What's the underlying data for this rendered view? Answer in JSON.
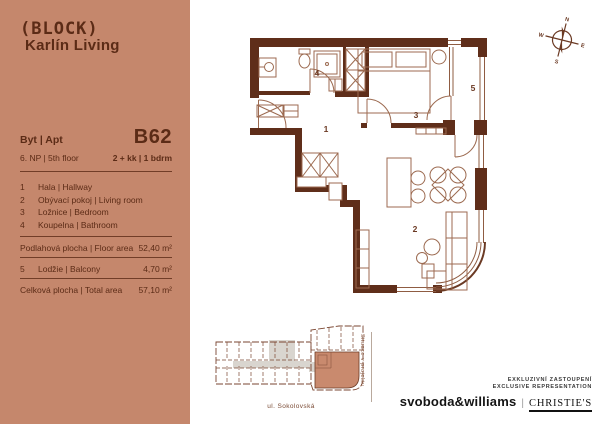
{
  "panel": {
    "logo_line1": "(BLOCK)",
    "logo_line2": "Karlín Living",
    "apt_label": "Byt | Apt",
    "apt_number": "B62",
    "floor": "6. NP | 5th floor",
    "layout": "2 + kk | 1 bdrm",
    "rooms": [
      {
        "num": "1",
        "name": "Hala | Hallway"
      },
      {
        "num": "2",
        "name": "Obývací pokoj | Living room"
      },
      {
        "num": "3",
        "name": "Ložnice | Bedroom"
      },
      {
        "num": "4",
        "name": "Koupelna | Bathroom"
      }
    ],
    "floor_area_label": "Podlahová plocha | Floor area",
    "floor_area_value": "52,40 m²",
    "balcony_num": "5",
    "balcony_label": "Lodžie | Balcony",
    "balcony_value": "4,70 m²",
    "total_label": "Celková plocha | Total area",
    "total_value": "57,10 m²"
  },
  "plan": {
    "labels": {
      "hall": "1",
      "living": "2",
      "bedroom": "3",
      "bathroom": "4",
      "balcony": "5"
    }
  },
  "compass": {
    "n": "N",
    "e": "E",
    "s": "S",
    "w": "W"
  },
  "siteplan": {
    "street": "ul. Sokolovská",
    "side_label": "Situace v projektu"
  },
  "branding": {
    "line1": "EXKLUZIVNÍ ZASTOUPENÍ",
    "line2": "EXCLUSIVE REPRESENTATION",
    "agency": "svoboda&williams",
    "separator": "|",
    "partner": "CHRISTIE'S"
  },
  "colors": {
    "panel": "#c5876c",
    "wall": "#5f2e1a",
    "furniture": "#9c6a50",
    "highlight": "#c98a6e"
  }
}
